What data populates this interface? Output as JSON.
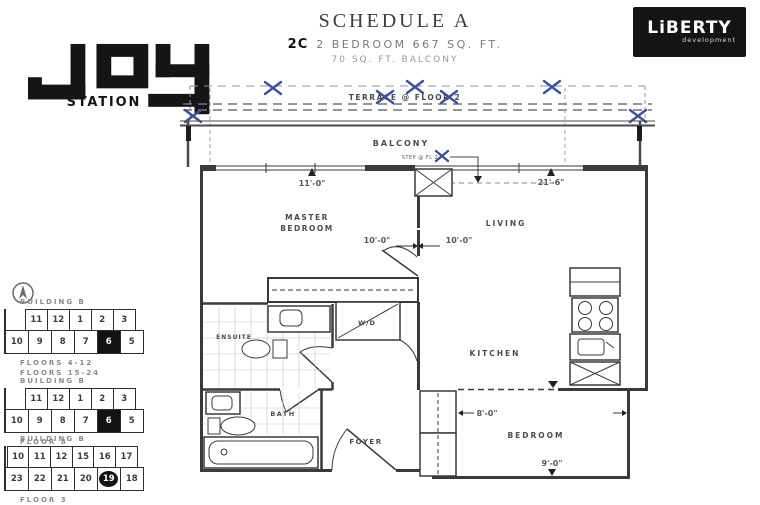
{
  "header": {
    "logo": {
      "word": "JOY",
      "sub": "STATION"
    },
    "schedule_title": "SCHEDULE A",
    "unit_code": "2C",
    "unit_description": "2 BEDROOM 667 SQ. FT.",
    "balcony_description": "70 SQ. FT. BALCONY",
    "developer": {
      "name": "LiBERTY",
      "tagline": "development"
    }
  },
  "plan": {
    "outdoor": {
      "terrace_label": "TERRACE @ FLOOR 2",
      "balcony_label": "BALCONY",
      "step_label": "STEP @ FL 2"
    },
    "rooms": {
      "master_bedroom_line1": "MASTER",
      "master_bedroom_line2": "BEDROOM",
      "living": "LIVING",
      "ensuite": "ENSUITE",
      "laundry": "W/D",
      "kitchen": "KITCHEN",
      "bath": "BATH",
      "foyer": "FOYER",
      "bedroom": "BEDROOM"
    },
    "dimensions": {
      "master_width": "11'-0\"",
      "living_width": "21'-6\"",
      "master_depth": "10'-0\"",
      "living_depth": "10'-0\"",
      "bedroom_depth": "8'-0\"",
      "bedroom_width": "9'-0\""
    }
  },
  "keyplans": [
    {
      "building": "BUILDING B",
      "floor_labels": [
        "FLOORS 4-12",
        "FLOORS 15-24"
      ],
      "top_row": [
        "11",
        "12",
        "1",
        "2",
        "3"
      ],
      "bottom_row": [
        "10",
        "9",
        "8",
        "7",
        "6",
        "5"
      ],
      "highlighted_unit": "6",
      "highlight_style": "fill"
    },
    {
      "building": "BUILDING B",
      "floor_labels": [
        "FLOOR 8"
      ],
      "top_row": [
        "11",
        "12",
        "1",
        "2",
        "3"
      ],
      "bottom_row": [
        "10",
        "9",
        "8",
        "7",
        "6",
        "5"
      ],
      "highlighted_unit": "6",
      "highlight_style": "fill"
    },
    {
      "building": "BUILDING B",
      "floor_labels": [
        "FLOOR 3"
      ],
      "top_row": [
        "10",
        "11",
        "12",
        "15",
        "16",
        "17"
      ],
      "bottom_row": [
        "23",
        "22",
        "21",
        "20",
        "19",
        "18"
      ],
      "highlighted_unit": "19",
      "highlight_style": "circle"
    }
  ],
  "colors": {
    "marker_blue": "#3d50a0",
    "line_dark": "#3a3a3a",
    "accent_black": "#121212"
  }
}
